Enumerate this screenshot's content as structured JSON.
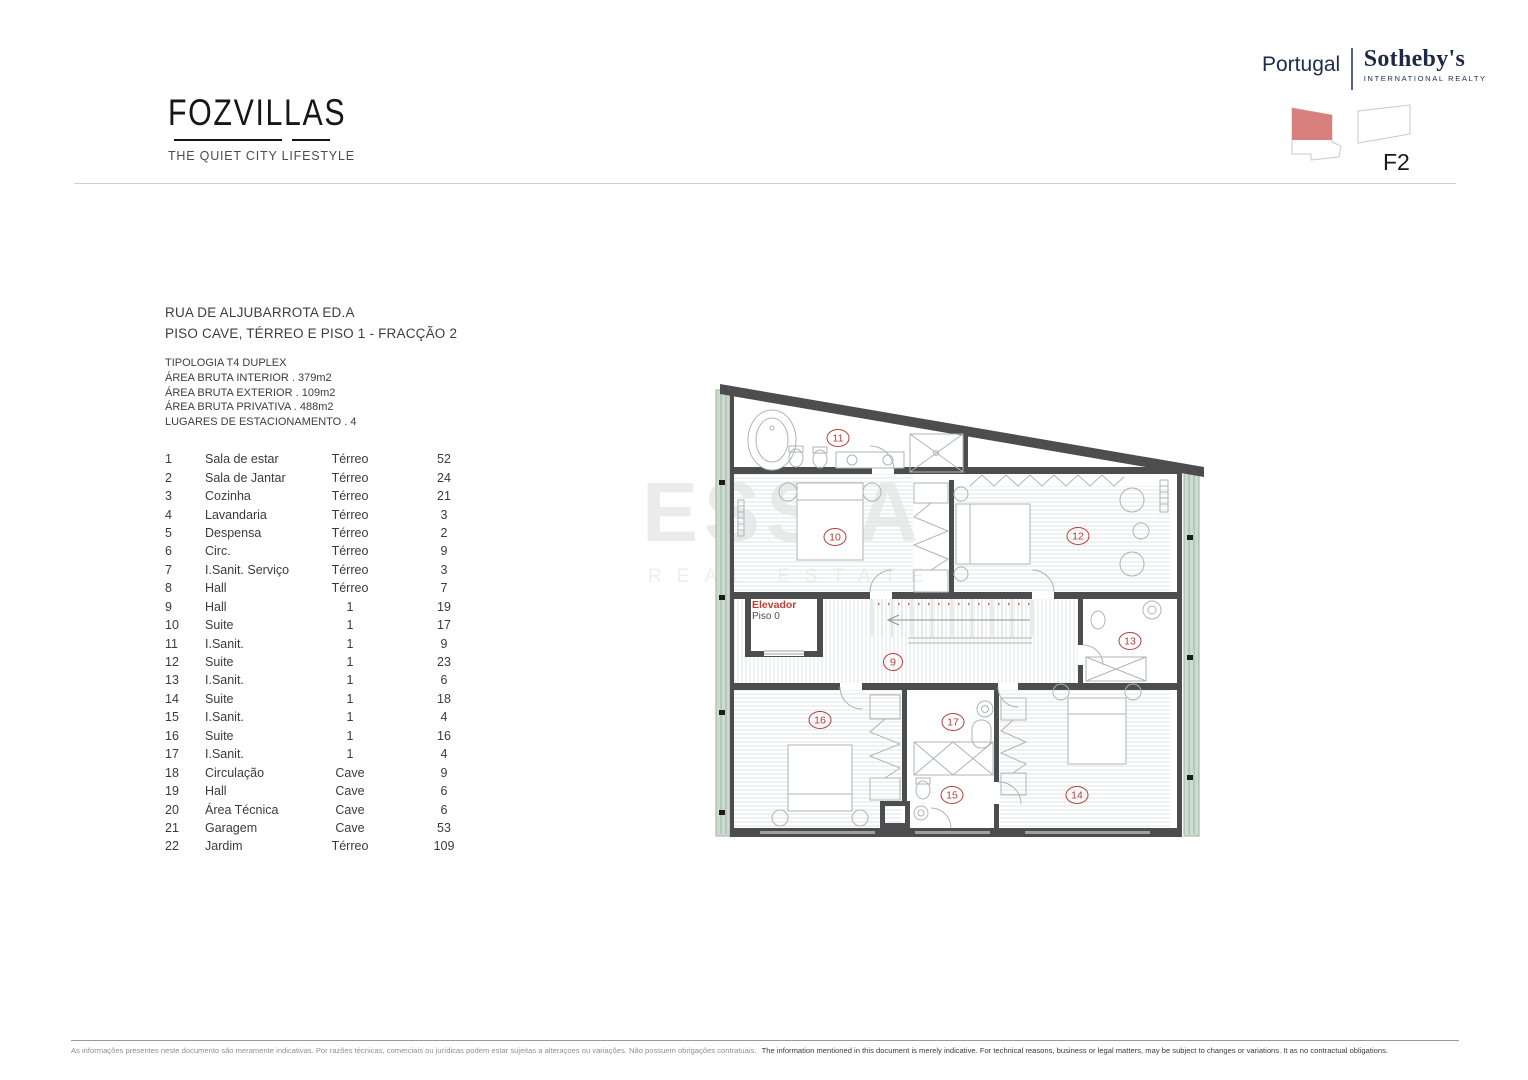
{
  "brand": {
    "logo": "FOZVILLAS",
    "tagline": "THE QUIET CITY LIFESTYLE"
  },
  "agency": {
    "region": "Portugal",
    "name": "Sotheby's",
    "subtitle": "INTERNATIONAL REALTY"
  },
  "unit": {
    "code": "F2"
  },
  "listing": {
    "address_line1": "RUA DE ALJUBARROTA ED.A",
    "address_line2": "PISO CAVE, TÉRREO E PISO 1 - FRACÇÃO  2",
    "details": [
      "TIPOLOGIA T4 DUPLEX",
      "ÁREA BRUTA INTERIOR   . 379m2",
      "ÁREA BRUTA EXTERIOR  .  109m2",
      "ÁREA BRUTA PRIVATIVA . 488m2",
      "LUGARES DE ESTACIONAMENTO . 4"
    ]
  },
  "rooms": [
    {
      "num": "1",
      "name": "Sala de estar",
      "floor": "Térreo",
      "area": "52"
    },
    {
      "num": "2",
      "name": "Sala de Jantar",
      "floor": "Térreo",
      "area": "24"
    },
    {
      "num": "3",
      "name": "Cozinha",
      "floor": "Térreo",
      "area": "21"
    },
    {
      "num": "4",
      "name": "Lavandaria",
      "floor": "Térreo",
      "area": "3"
    },
    {
      "num": "5",
      "name": "Despensa",
      "floor": "Térreo",
      "area": "2"
    },
    {
      "num": "6",
      "name": "Circ.",
      "floor": "Térreo",
      "area": "9"
    },
    {
      "num": "7",
      "name": "I.Sanit. Serviço",
      "floor": "Térreo",
      "area": "3"
    },
    {
      "num": "8",
      "name": "Hall",
      "floor": "Térreo",
      "area": "7"
    },
    {
      "num": "9",
      "name": "Hall",
      "floor": "1",
      "area": "19"
    },
    {
      "num": "10",
      "name": "Suite",
      "floor": "1",
      "area": "17"
    },
    {
      "num": "11",
      "name": "I.Sanit.",
      "floor": "1",
      "area": "9"
    },
    {
      "num": "12",
      "name": "Suite",
      "floor": "1",
      "area": "23"
    },
    {
      "num": "13",
      "name": "I.Sanit.",
      "floor": "1",
      "area": "6"
    },
    {
      "num": "14",
      "name": "Suite",
      "floor": "1",
      "area": "18"
    },
    {
      "num": "15",
      "name": "I.Sanit.",
      "floor": "1",
      "area": "4"
    },
    {
      "num": "16",
      "name": "Suite",
      "floor": "1",
      "area": "16"
    },
    {
      "num": "17",
      "name": "I.Sanit.",
      "floor": "1",
      "area": "4"
    },
    {
      "num": "18",
      "name": "Circulação",
      "floor": "Cave",
      "area": "9"
    },
    {
      "num": "19",
      "name": "Hall",
      "floor": "Cave",
      "area": "6"
    },
    {
      "num": "20",
      "name": "Área Técnica",
      "floor": "Cave",
      "area": "6"
    },
    {
      "num": "21",
      "name": "Garagem",
      "floor": "Cave",
      "area": "53"
    },
    {
      "num": "22",
      "name": "Jardim",
      "floor": "Térreo",
      "area": "109"
    }
  ],
  "floorplan": {
    "elevator": {
      "label": "Elevador",
      "floor": "Piso 0"
    },
    "labels": {
      "r9": "9",
      "r10": "10",
      "r11": "11",
      "r12": "12",
      "r13": "13",
      "r14": "14",
      "r15": "15",
      "r16": "16",
      "r17": "17"
    }
  },
  "watermark": {
    "line1": "ESSIA",
    "line2": "REAL ESTATE"
  },
  "footer": {
    "pt": "As informações presentes neste documento são meramente indicativas. Por razões técnicas, comerciais ou jurídicas podem estar sujeitas a alteraçoes ou variações. Não possuem obrigações contratuais.",
    "en": "The information mentioned in this document is merely indicative. For technical reasons, business or legal matters, may be subject to changes or variations. It as no contractual obligations."
  },
  "colors": {
    "accent_red": "#b5403a",
    "salmon": "#d8807e",
    "navy": "#1d2945",
    "plan_green": "#ccdccf",
    "wall": "#4d4d50"
  }
}
